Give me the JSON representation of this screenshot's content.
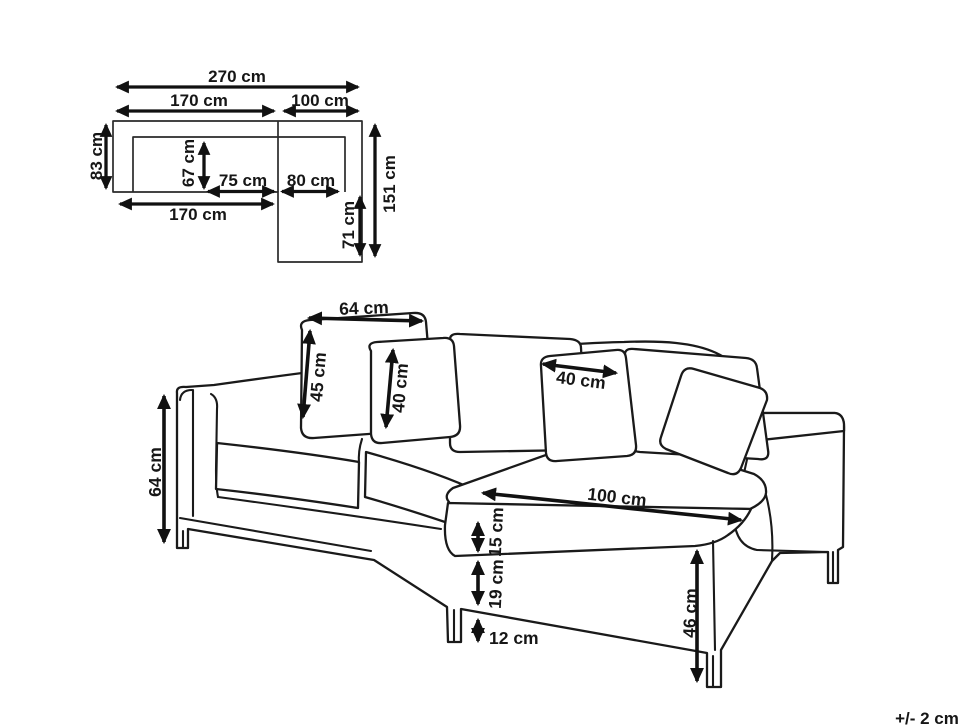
{
  "unit": "cm",
  "tolerance_note": "+/- 2 cm",
  "top_view": {
    "overall_width": "270 cm",
    "left_section_width": "170 cm",
    "right_section_width": "100 cm",
    "left_depth": "83 cm",
    "inner_depth": "67 cm",
    "inner_left_width": "75 cm",
    "inner_right_width": "80 cm",
    "bottom_width": "170 cm",
    "chaise_extension": "71 cm",
    "overall_depth": "151 cm"
  },
  "perspective_view": {
    "back_cushion_width": "64 cm",
    "back_cushion_height": "45 cm",
    "small_cushion_height": "40 cm",
    "small_cushion_width": "40 cm",
    "overall_height": "64 cm",
    "chaise_length": "100 cm",
    "seat_cushion_thickness": "15 cm",
    "base_height": "19 cm",
    "leg_height": "12 cm",
    "seat_height": "46 cm"
  }
}
